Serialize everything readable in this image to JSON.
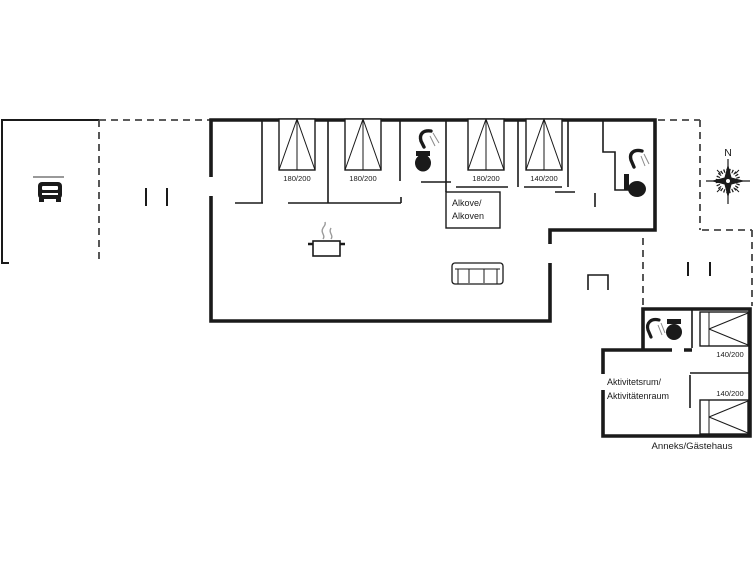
{
  "floorplan": {
    "compass_label": "N",
    "main_house": {
      "bed_labels": [
        "180/200",
        "180/200",
        "180/200",
        "140/200"
      ],
      "alkove_line1": "Alkove/",
      "alkove_line2": "Alkoven"
    },
    "annex": {
      "bed_labels": [
        "140/200",
        "140/200"
      ],
      "room_line1": "Aktivitetsrum/",
      "room_line2": "Aktivitätenraum",
      "caption": "Anneks/Gästehaus"
    },
    "colors": {
      "wall": "#1a1a1a",
      "dashed_line": "#454545",
      "accent_gray": "#999999",
      "background": "#ffffff"
    }
  }
}
